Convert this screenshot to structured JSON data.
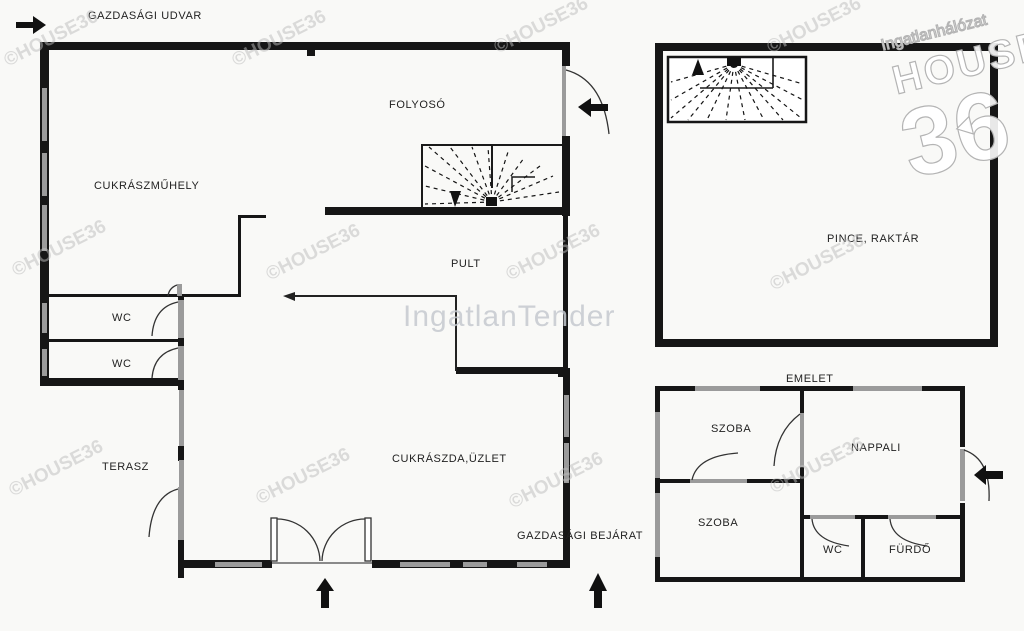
{
  "colors": {
    "wall": "#161616",
    "window": "#9b9b9b",
    "watermark": "#bdbdbd"
  },
  "yard_label": "GAZDASÁGI UDVAR",
  "ground_floor": {
    "folyoso": "FOLYOSÓ",
    "cukraszmuhely": "CUKRÁSZMŰHELY",
    "pult": "PULT",
    "wc1": "WC",
    "wc2": "WC",
    "terasz": "TERASZ",
    "cukraszda": "CUKRÁSZDA,ÜZLET",
    "service_entrance": "GAZDASÁGI BEJÁRAT"
  },
  "basement": {
    "pince": "PINCE, RAKTÁR"
  },
  "upper_floor": {
    "title": "EMELET",
    "szoba1": "SZOBA",
    "nappali": "NAPPALI",
    "szoba2": "SZOBA",
    "wc": "WC",
    "furdo": "FÜRDŐ"
  },
  "watermarks": {
    "copyright": "©HOUSE36",
    "brand": "IngatlanTender",
    "logo_top": "Ingatlanhálózat",
    "logo_mid": "HOUSE",
    "logo_big": "36"
  }
}
